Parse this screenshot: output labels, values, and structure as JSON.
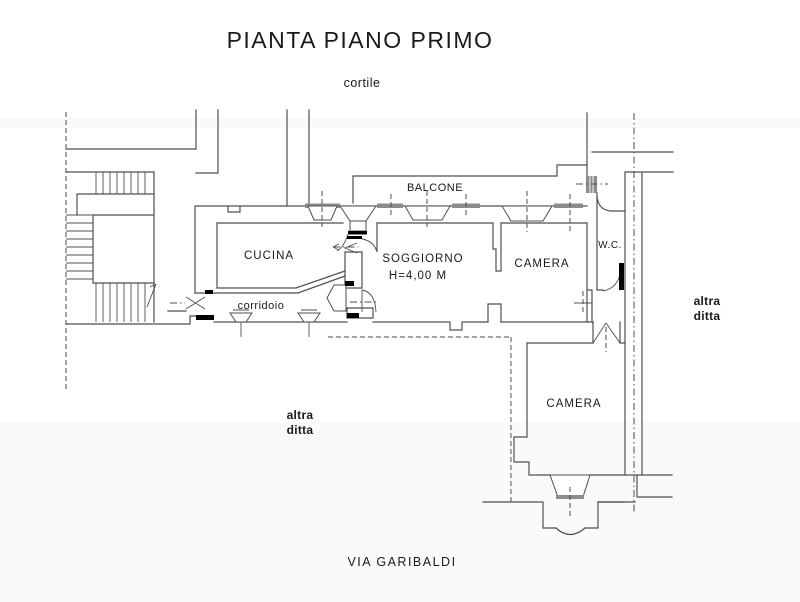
{
  "drawing": {
    "title": "PIANTA PIANO PRIMO",
    "courtyard_label": "cortile",
    "street_label": "VIA GARIBALDI",
    "rooms": {
      "balcone": "BALCONE",
      "cucina": "CUCINA",
      "soggiorno": "SOGGIORNO",
      "soggiorno_height": "H=4,00 M",
      "camera_top": "CAMERA",
      "wc": "W.C.",
      "corridoio": "corridoio",
      "camera_bottom": "CAMERA"
    },
    "neighbors": {
      "right_line1": "altra",
      "right_line2": "ditta",
      "left_line1": "altra",
      "left_line2": "ditta"
    }
  },
  "colors": {
    "line": "#4f4f4f",
    "sill": "#8c8c8c",
    "jamb": "#000000",
    "text": "#1a1a1a",
    "background": "#ffffff"
  }
}
